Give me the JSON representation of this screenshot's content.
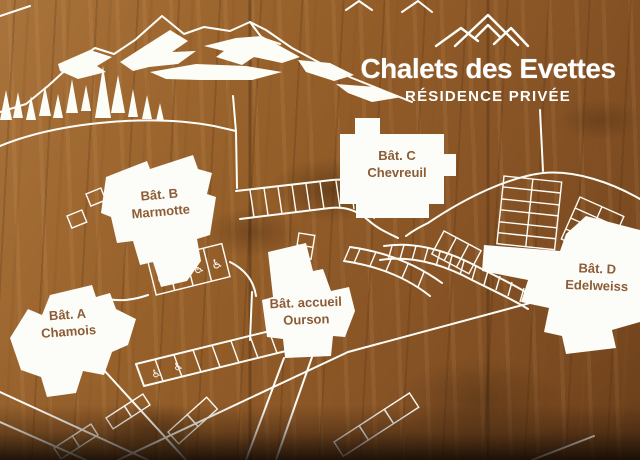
{
  "sign": {
    "title": "Chalets des Evettes",
    "subtitle": "RÉSIDENCE PRIVÉE"
  },
  "buildings": [
    {
      "id": "A",
      "label": "Bât. A",
      "name": "Chamois"
    },
    {
      "id": "B",
      "label": "Bât. B",
      "name": "Marmotte"
    },
    {
      "id": "C",
      "label": "Bât. C",
      "name": "Chevreuil"
    },
    {
      "id": "D",
      "label": "Bât. D",
      "name": "Edelweiss"
    },
    {
      "id": "accueil",
      "label": "Bât. accueil",
      "name": "Ourson"
    }
  ],
  "map": {
    "accessible_symbol": "♿",
    "accessible_spaces": 6
  },
  "colors": {
    "artwork_line": "#fdfdf8",
    "building_fill": "#fcfcf8",
    "building_label": "#8d5c36",
    "wood_light": "#a9733c",
    "wood_dark": "#6e411c"
  }
}
